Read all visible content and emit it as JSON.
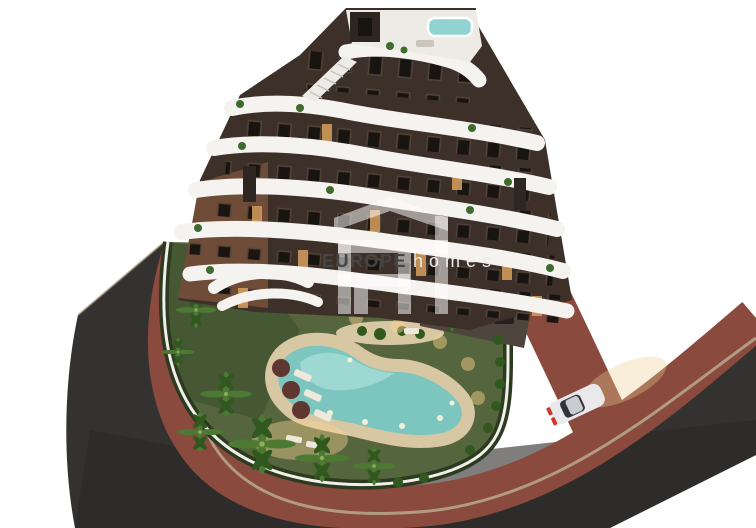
{
  "watermark": {
    "logo_name": "europe-homes-monogram",
    "brand_bold": "EUROPE",
    "brand_light": "homes"
  },
  "palette": {
    "background": "#ffffff",
    "asphalt": "#343231",
    "asphalt_shade": "#2a2827",
    "sidewalk": "#8a4a3d",
    "curb": "#b5a48a",
    "lawn": "#55663e",
    "lawn_shadow": "#3a4a2c",
    "hedge": "#2c3a20",
    "wall_white": "#f0efe9",
    "pool_water": "#7cc6bf",
    "pool_water_light": "#a8ded8",
    "pool_deck": "#d8c7a3",
    "facade_dark": "#3c3029",
    "facade_light": "#6e4c38",
    "band_white": "#f4f3ef",
    "roof_white": "#edebe5",
    "roof_structure": "#2e2620",
    "jacuzzi": "#8fd4d0",
    "window_dark": "#17130f",
    "window_lit": "#d8a05e",
    "palm_green": "#4c7a33",
    "palm_dark": "#31591f",
    "trunk_brown": "#6d5234",
    "umbrella": "#5f3630",
    "lounger_white": "#efe9dd",
    "paving_dark": "#4e463c",
    "furniture_dark": "#26211c",
    "car_body": "#e9e9eb",
    "car_roof": "#c9cdd2",
    "car_glass": "#30343a",
    "taillight_red": "#d1342b",
    "headlight_glow": "rgba(234,205,150,0.35)",
    "pool_glow": "rgba(255,214,150,0.40)",
    "watermark_white": "rgba(255,255,255,0.52)",
    "watermark_text_dark": "#454545",
    "watermark_text_light": "#ececec"
  }
}
